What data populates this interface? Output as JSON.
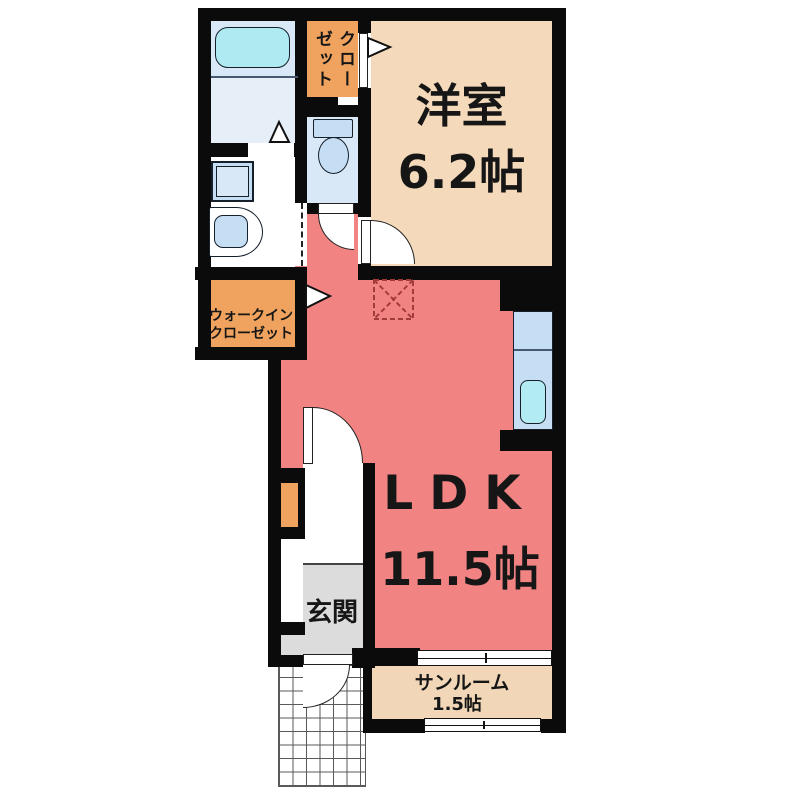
{
  "floorplan": {
    "rooms": {
      "yoshitsu": {
        "label": "洋室",
        "size": "6.2帖"
      },
      "ldk": {
        "label": "LDK",
        "size": "11.5帖"
      },
      "sunroom": {
        "label": "サンルーム",
        "size": "1.5帖"
      },
      "genkan": {
        "label": "玄関"
      },
      "wic": {
        "label_line1": "ウォークイン",
        "label_line2": "クローゼット"
      },
      "closet": {
        "label": "クローゼット"
      }
    },
    "symbols": {
      "bathtub": "bathtub",
      "washing_machine": "washing-machine-space",
      "washbasin": "washbasin",
      "toilet": "toilet",
      "kitchen_sink": "kitchen-counter-with-sink",
      "refrigerator_space": "refrigerator-space-dashed-box",
      "porch": "tiled-entrance-porch",
      "windows": "sliding-window-symbols",
      "doors": "door-swing-arcs"
    },
    "colors": {
      "wall": "#0b0b0b",
      "ldk_pink": "#F28383",
      "room_tan": "#F4DABB",
      "sun_tan": "#F1D7B7",
      "closet_orange": "#F0A35E",
      "entrance_gray": "#DCDCDC",
      "water_blue": "#D9E8F6",
      "bath_floor": "#E6EFF8",
      "fixture_blue": "#C6DEF4",
      "tub_cyan": "#AFE9F2",
      "sink_cyan": "#B2ECF2",
      "fridge_red": "#A23B3B"
    }
  }
}
